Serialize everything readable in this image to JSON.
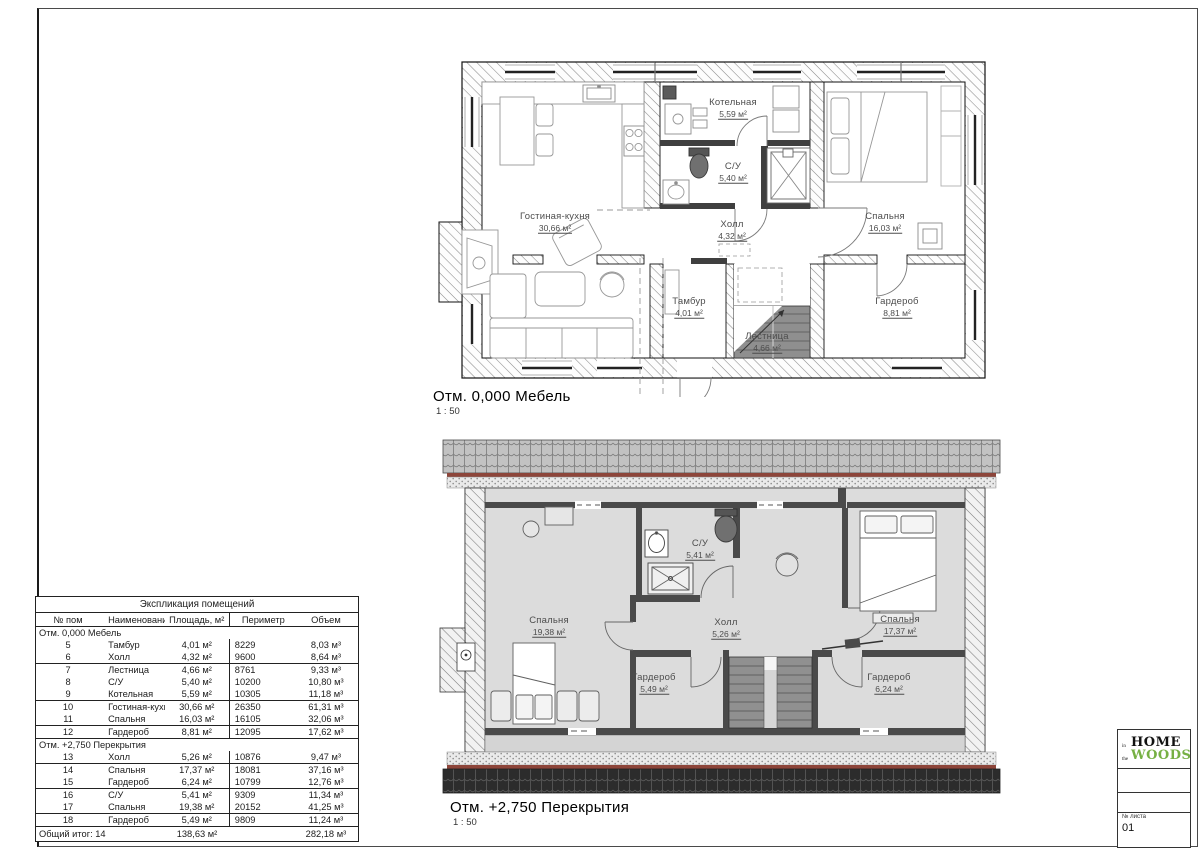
{
  "plans": [
    {
      "title": "Отм. 0,000 Мебель",
      "scale": "1 : 50",
      "rooms": [
        {
          "name": "Гостиная-кухня",
          "area": "30,66 м²"
        },
        {
          "name": "Котельная",
          "area": "5,59 м²"
        },
        {
          "name": "С/У",
          "area": "5,40 м²"
        },
        {
          "name": "Холл",
          "area": "4,32 м²"
        },
        {
          "name": "Спальня",
          "area": "16,03 м²"
        },
        {
          "name": "Тамбур",
          "area": "4,01 м²"
        },
        {
          "name": "Лестница",
          "area": "4,66 м²"
        },
        {
          "name": "Гардероб",
          "area": "8,81 м²"
        }
      ]
    },
    {
      "title": "Отм. +2,750 Перекрытия",
      "scale": "1 : 50",
      "rooms": [
        {
          "name": "Спальня",
          "area": "19,38 м²"
        },
        {
          "name": "С/У",
          "area": "5,41 м²"
        },
        {
          "name": "Холл",
          "area": "5,26 м²"
        },
        {
          "name": "Спальня",
          "area": "17,37 м²"
        },
        {
          "name": "Гардероб",
          "area": "5,49 м²"
        },
        {
          "name": "Гардероб",
          "area": "6,24 м²"
        }
      ]
    }
  ],
  "table": {
    "title": "Экспликация помещений",
    "columns": [
      "№ пом",
      "Наименование",
      "Площадь, м²",
      "Периметр",
      "Объем"
    ],
    "sections": [
      {
        "label": "Отм. 0,000 Мебель",
        "rows": [
          {
            "num": "5",
            "name": "Тамбур",
            "area": "4,01 м²",
            "perimeter": "8229",
            "volume": "8,03 м³",
            "group_end": false
          },
          {
            "num": "6",
            "name": "Холл",
            "area": "4,32 м²",
            "perimeter": "9600",
            "volume": "8,64 м³",
            "group_end": true
          },
          {
            "num": "7",
            "name": "Лестница",
            "area": "4,66 м²",
            "perimeter": "8761",
            "volume": "9,33 м³",
            "group_end": false
          },
          {
            "num": "8",
            "name": "С/У",
            "area": "5,40 м²",
            "perimeter": "10200",
            "volume": "10,80 м³",
            "group_end": false
          },
          {
            "num": "9",
            "name": "Котельная",
            "area": "5,59 м²",
            "perimeter": "10305",
            "volume": "11,18 м³",
            "group_end": true
          },
          {
            "num": "10",
            "name": "Гостиная-кухня",
            "area": "30,66 м²",
            "perimeter": "26350",
            "volume": "61,31 м³",
            "group_end": false
          },
          {
            "num": "11",
            "name": "Спальня",
            "area": "16,03 м²",
            "perimeter": "16105",
            "volume": "32,06 м³",
            "group_end": true
          },
          {
            "num": "12",
            "name": "Гардероб",
            "area": "8,81 м²",
            "perimeter": "12095",
            "volume": "17,62 м³",
            "group_end": true
          }
        ]
      },
      {
        "label": "Отм. +2,750 Перекрытия",
        "rows": [
          {
            "num": "13",
            "name": "Холл",
            "area": "5,26 м²",
            "perimeter": "10876",
            "volume": "9,47 м³",
            "group_end": true
          },
          {
            "num": "14",
            "name": "Спальня",
            "area": "17,37 м²",
            "perimeter": "18081",
            "volume": "37,16 м³",
            "group_end": false
          },
          {
            "num": "15",
            "name": "Гардероб",
            "area": "6,24 м²",
            "perimeter": "10799",
            "volume": "12,76 м³",
            "group_end": true
          },
          {
            "num": "16",
            "name": "С/У",
            "area": "5,41 м²",
            "perimeter": "9309",
            "volume": "11,34 м³",
            "group_end": false
          },
          {
            "num": "17",
            "name": "Спальня",
            "area": "19,38 м²",
            "perimeter": "20152",
            "volume": "41,25 м³",
            "group_end": true
          },
          {
            "num": "18",
            "name": "Гардероб",
            "area": "5,49 м²",
            "perimeter": "9809",
            "volume": "11,24 м³",
            "group_end": true
          }
        ]
      }
    ],
    "total": {
      "label": "Общий итог: 14",
      "area": "138,63 м²",
      "volume": "282,18 м³"
    }
  },
  "titleblock": {
    "logo": {
      "home": "HOME",
      "in": "in",
      "the": "the",
      "woods": "WOODS",
      "woods_color": "#76b043"
    },
    "sheet_number_label": "№ листа",
    "sheet_number": "01"
  },
  "colors": {
    "accent_green": "#76b043",
    "roof_dark": "#2c2c2c",
    "roof_red": "#8d453a",
    "attic_floor": "#dcdcdc"
  }
}
